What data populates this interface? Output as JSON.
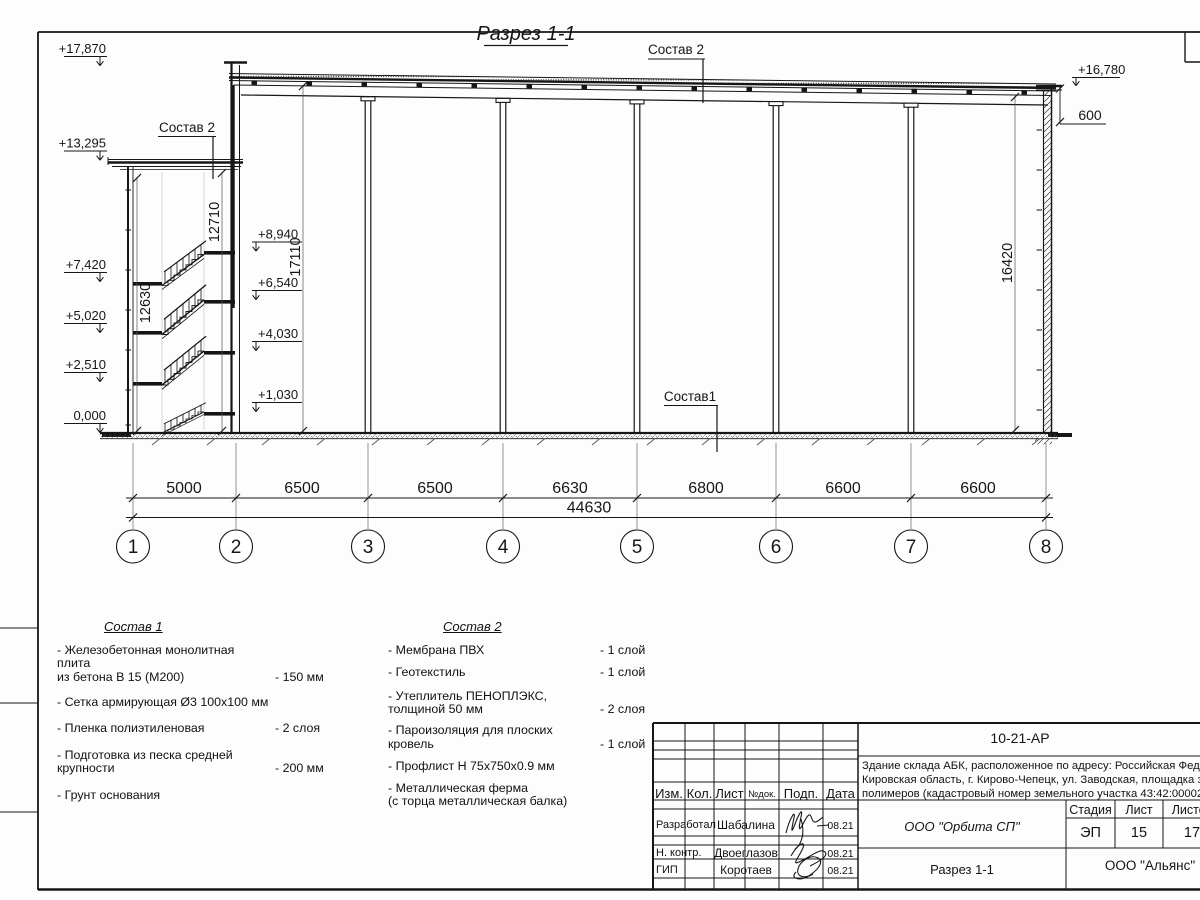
{
  "drawing": {
    "title": "Разрез 1-1",
    "labels": {
      "sostav2": "Состав 2",
      "sostav1": "Состав1"
    },
    "elevations": {
      "top_left": "+17,870",
      "abk_roof": "+13,295",
      "floor3": "+7,420",
      "floor2": "+5,020",
      "floor1": "+2,510",
      "ground": "0,000",
      "landing4": "+8,940",
      "landing3": "+6,540",
      "landing2": "+4,030",
      "landing1": "+1,030",
      "top_right": "+16,780"
    },
    "parapet_dim": "600",
    "vertical_dims": {
      "abk_inner": "12630",
      "abk_outer": "12710",
      "hall_left": "17110",
      "hall_right": "16420"
    },
    "span_dims": [
      "5000",
      "6500",
      "6500",
      "6630",
      "6800",
      "6600",
      "6600"
    ],
    "total_dim": "44630",
    "axes": [
      "1",
      "2",
      "3",
      "4",
      "5",
      "6",
      "7",
      "8"
    ]
  },
  "legend1": {
    "title": "Состав 1",
    "items": [
      {
        "name": "- Железобетонная  монолитная плита\nиз бетона В 15 (М200)",
        "value": "- 150 мм"
      },
      {
        "name": "- Сетка армирующая Ø3 100x100 мм",
        "value": ""
      },
      {
        "name": "- Пленка полиэтиленовая",
        "value": "-  2 слоя"
      },
      {
        "name": "- Подготовка из песка средней\nкрупности",
        "value": "- 200 мм"
      },
      {
        "name": "- Грунт основания",
        "value": ""
      }
    ]
  },
  "legend2": {
    "title": "Состав 2",
    "items": [
      {
        "name": "- Мембрана ПВХ",
        "value": "- 1 слой"
      },
      {
        "name": "- Геотекстиль",
        "value": "- 1 слой"
      },
      {
        "name": "- Утеплитель ПЕНОПЛЭКС,\nтолщиной 50 мм",
        "value": "- 2 слоя"
      },
      {
        "name": "- Пароизоляция для плоских кровель",
        "value": "- 1 слой"
      },
      {
        "name": "- Профлист Н 75х750х0.9 мм",
        "value": ""
      },
      {
        "name": "- Металлическая ферма\n(с торца металлическая балка)",
        "value": ""
      }
    ]
  },
  "titleblock": {
    "doc_code": "10-21-АР",
    "description_lines": [
      "Здание склада АБК, расположенное по адресу: Российская Федерация,",
      "Кировская область, г. Кирово-Чепецк, ул. Заводская, площадка завода",
      "полимеров (кадастровый номер земельного участка 43:42:000022:3"
    ],
    "columns": {
      "izm": "Изм.",
      "kol": "Кол.",
      "list": "Лист",
      "ndoc": "№док.",
      "podp": "Подп.",
      "data": "Дата"
    },
    "rows": [
      {
        "role": "Разработал",
        "name": "Шабалина",
        "date": "08.21"
      },
      {
        "role": "Н. контр.",
        "name": "Двоеглазов",
        "date": "08.21"
      },
      {
        "role": "ГИП",
        "name": "Коротаев",
        "date": "08.21"
      }
    ],
    "org": "ООО \"Орбита СП\"",
    "stage_label": "Стадия",
    "sheet_label": "Лист",
    "sheets_label": "Листов",
    "stage": "ЭП",
    "sheet": "15",
    "sheets": "17",
    "drawing_name": "Разрез 1-1",
    "company": "ООО \"Альянс\""
  }
}
